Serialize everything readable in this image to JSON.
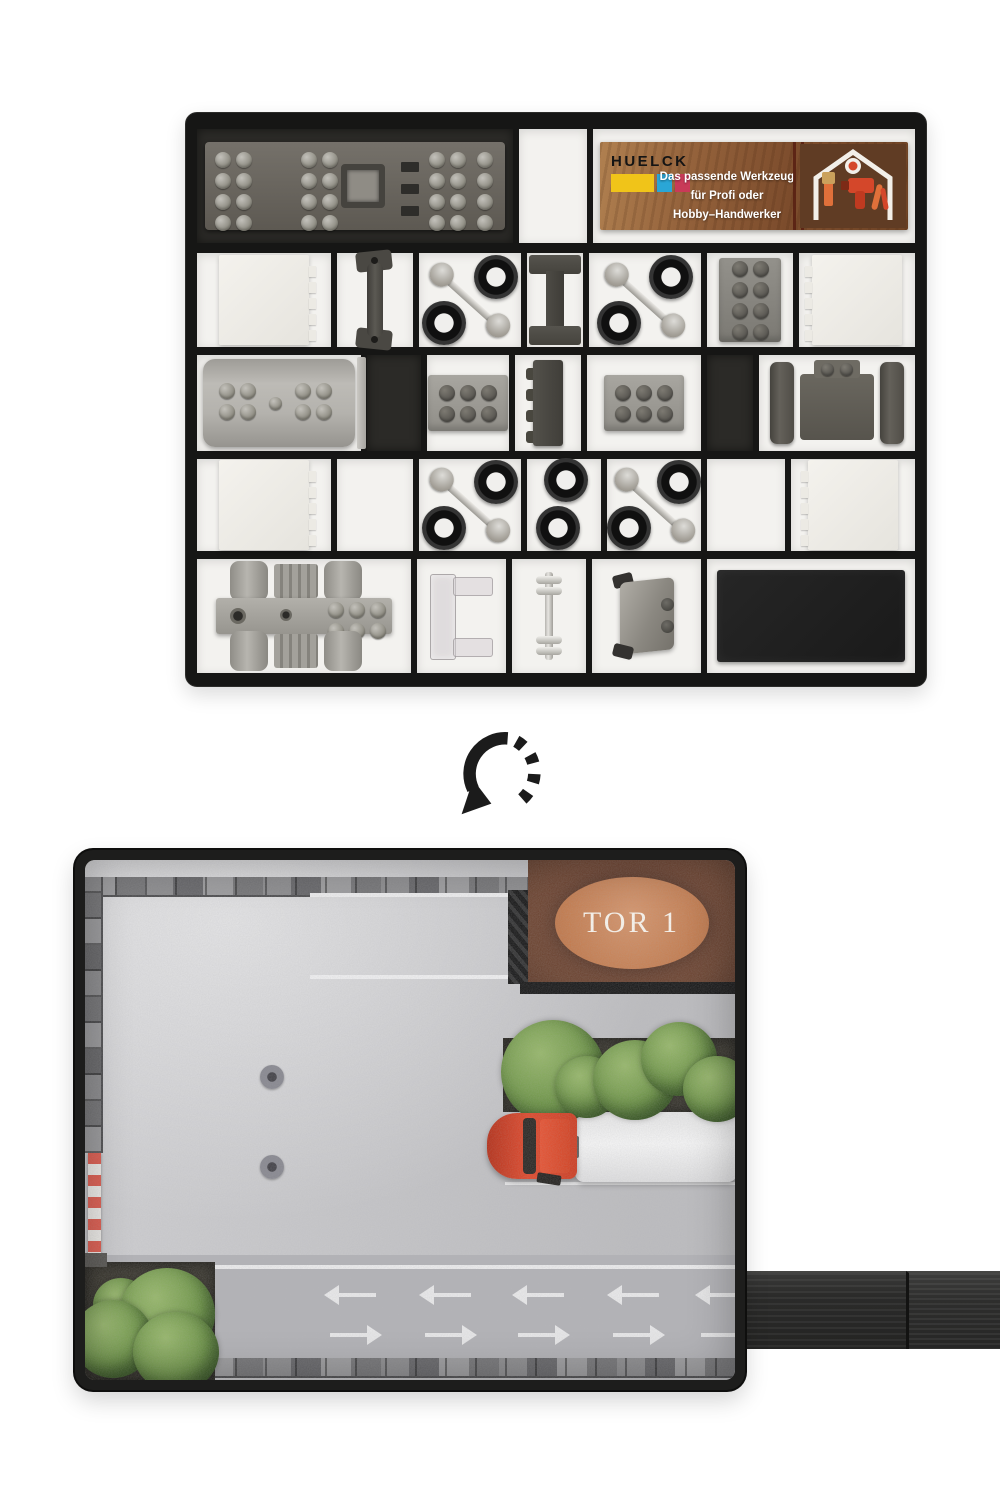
{
  "card": {
    "brand": "HUELCK",
    "tagline_line1": "Das passende Werkzeug",
    "tagline_line2": "für Profi oder",
    "tagline_line3": "Hobby–Handwerker"
  },
  "mat": {
    "gate_sign": "TOR 1"
  },
  "icons": {
    "rotate_arrow": "rotate-arrow-icon",
    "tools_house": "tools-illustration"
  },
  "colors": {
    "tray_plastic": "#161615",
    "card_wood": "#8a5a38",
    "brand_yellow": "#f0c419",
    "brand_cyan": "#2aa6d6",
    "brand_magenta": "#c93a58",
    "truck_red": "#d93e20",
    "sign_oval": "#c77a4a",
    "sign_board": "#5d3224",
    "bush_green": "#6b9443",
    "concrete_gray": "#c9c9cc",
    "pole_red": "#e2584a"
  }
}
